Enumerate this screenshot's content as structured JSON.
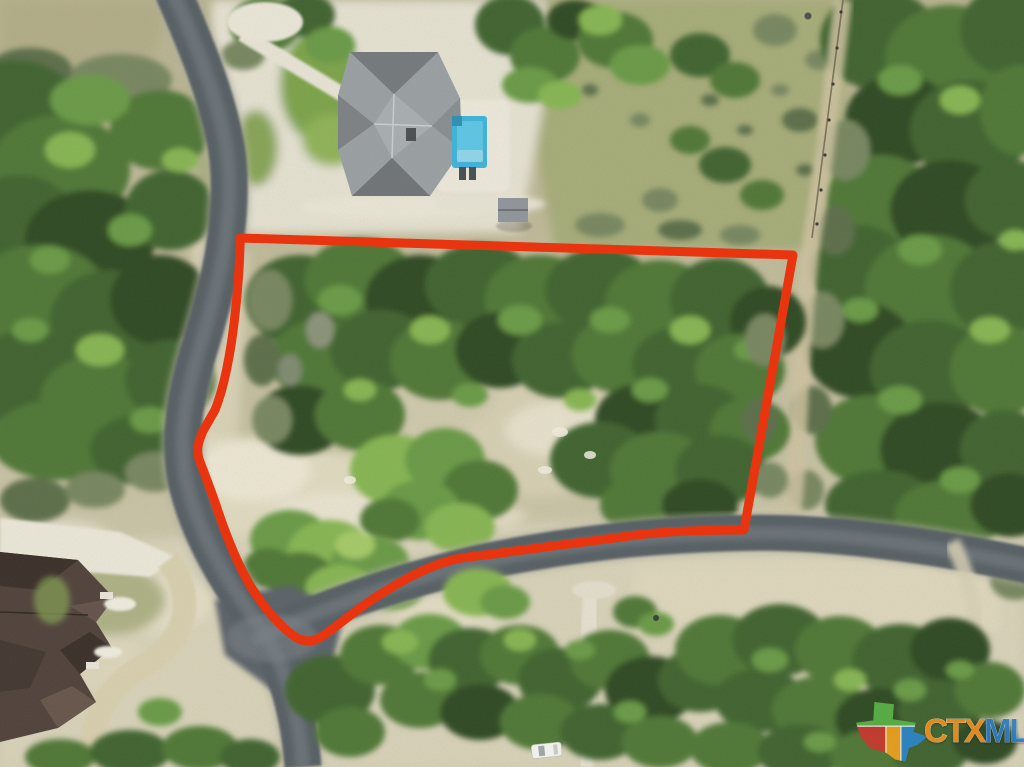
{
  "scene": {
    "alt": "Aerial drone photo of a wooded vacant lot outlined in red at a curving road intersection, with a neighboring house and swimming pool at top and a metal-roof house at lower left"
  },
  "boundary": {
    "color": "#e93410"
  },
  "watermark": {
    "part1": "CTX",
    "part2": "MLS",
    "part1_color": "#ee8f1f",
    "part2_color": "#2f7cc0",
    "logo_colors": {
      "green": "#5bb449",
      "red": "#c9392f",
      "orange": "#eea11f",
      "blue": "#2e86c8"
    }
  }
}
